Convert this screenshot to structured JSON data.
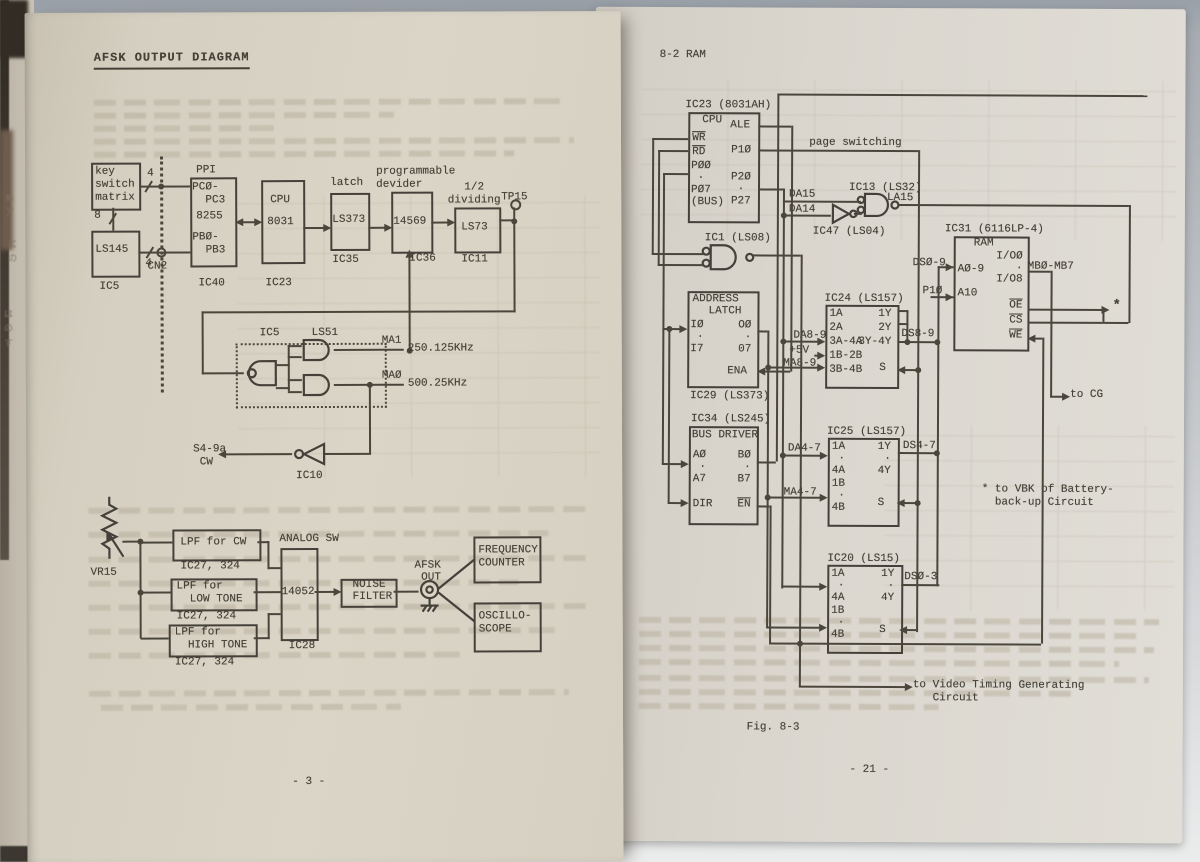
{
  "colors": {
    "paper_left": "#d7d1c3",
    "paper_right": "#dcd8d0",
    "ink": "#46423a",
    "desk": "#aab0b6"
  },
  "lp": {
    "title": "AFSK OUTPUT DIAGRAM",
    "page_number": "- 3 -",
    "key_switch": "key\nswitch\nmatrix",
    "bus4a": "4",
    "bus8": "8",
    "bus4b": "4",
    "cn2": "CN2",
    "ls145": "LS145",
    "ic5": "IC5",
    "ppi": "PPI",
    "ppi_top": "PCØ-\n  PC3",
    "ppi_mid": "8255",
    "ppi_bot": "PBØ-\n  PB3",
    "ic40": "IC40",
    "cpu": "CPU",
    "cpu_num": "8031",
    "ic23": "IC23",
    "latch": "latch",
    "ls373": "LS373",
    "ic35": "IC35",
    "prog": "programmable\ndevider",
    "n14569": "14569",
    "ic36": "IC36",
    "half": "1/2\ndividing",
    "ls73": "LS73",
    "ic11": "IC11",
    "tp15": "TP15",
    "ic5b": "IC5",
    "ls51": "LS51",
    "ma1": "MA1",
    "f1": "250.125KHz",
    "ma0": "MAØ",
    "f0": "500.25KHz",
    "s49a": "S4-9a\n CW",
    "ic10": "IC10",
    "vr15": "VR15",
    "lpf1": "LPF for CW",
    "ic27a": "IC27, 324",
    "lpf2": "LPF for\n  LOW TONE",
    "ic27b": "IC27, 324",
    "lpf3": "LPF for\n  HIGH TONE",
    "ic27c": "IC27, 324",
    "analog": "ANALOG SW",
    "n14052": "14052",
    "ic28": "IC28",
    "noise": "NOISE\nFILTER",
    "afsk": "AFSK\n OUT",
    "freq": "FREQUENCY\nCOUNTER",
    "osc": "OSCILLO-\nSCOPE"
  },
  "rp": {
    "header": "8-2 RAM",
    "ic23": "IC23 (8031AH)",
    "cpu": "CPU",
    "ale": "ALE",
    "wr": "WR",
    "rd": "RD",
    "p10": "P1Ø",
    "p0": "PØØ\n ·\nPØ7\n(BUS)",
    "p2": "P2Ø\n ·\nP27",
    "page_switching": "page switching",
    "da15": "DA15",
    "da14": "DA14",
    "ic13": "IC13 (LS32)",
    "la15": "LA15",
    "ic47": "IC47 (LS04)",
    "ic1": "IC1 (LS08)",
    "addr1": "ADDRESS",
    "addr2": "LATCH",
    "i_pins": "IØ\n ·\nI7",
    "o_pins": "OØ\n·\n07",
    "ena": "ENA",
    "ic29": "IC29 (LS373)",
    "ic24": "IC24 (LS157)",
    "ic24_l": "1A\n2A\n3A-4A\n1B-2B\n3B-4B",
    "ic24_r": "1Y\n2Y\n3Y-4Y",
    "s1": "S",
    "da89": "DA8-9",
    "p5v": "+5V",
    "ma89": "MA8-9",
    "ds89": "DS8-9",
    "ds09": "DSØ-9",
    "p10b": "P1Ø",
    "ic31": "IC31 (6116LP-4)",
    "ram": "RAM",
    "a09": "AØ-9",
    "a10": "A10",
    "io": "I/OØ\n  ·\nI/O8",
    "oe": "OE",
    "cs": "CS",
    "we": "WE",
    "mb": "MBØ-MB7",
    "star": "*",
    "to_cg": "to CG",
    "ic34": "IC34 (LS245)",
    "busdrv": "BUS DRIVER",
    "a_pins": "AØ\n ·\nA7",
    "dir": "DIR",
    "b_pins": "BØ\n ·\nB7",
    "en": "EN",
    "ic25": "IC25 (LS157)",
    "ic25_l": "1A\n ·\n4A\n1B\n ·\n4B",
    "ic25_r": "1Y\n ·\n4Y",
    "s2": "S",
    "da47": "DA4-7",
    "ma47": "MA4-7",
    "ds47": "DS4-7",
    "vbk": "* to VBK of Battery-\n  back-up Circuit",
    "ic20": "IC20 (LS15)",
    "ic20_l": "1A\n ·\n4A\n1B\n ·\n4B",
    "ic20_r": "1Y\n ·\n4Y",
    "s3": "S",
    "ds03": "DSØ-3",
    "to_video": "to Video Timing Generating\n   Circuit",
    "fig": "Fig. 8-3",
    "page_number": "- 21 -"
  },
  "edge": {
    "jp1": "め\nア",
    "jp2": "に\nの",
    "jp3": "は\nの\nす"
  }
}
